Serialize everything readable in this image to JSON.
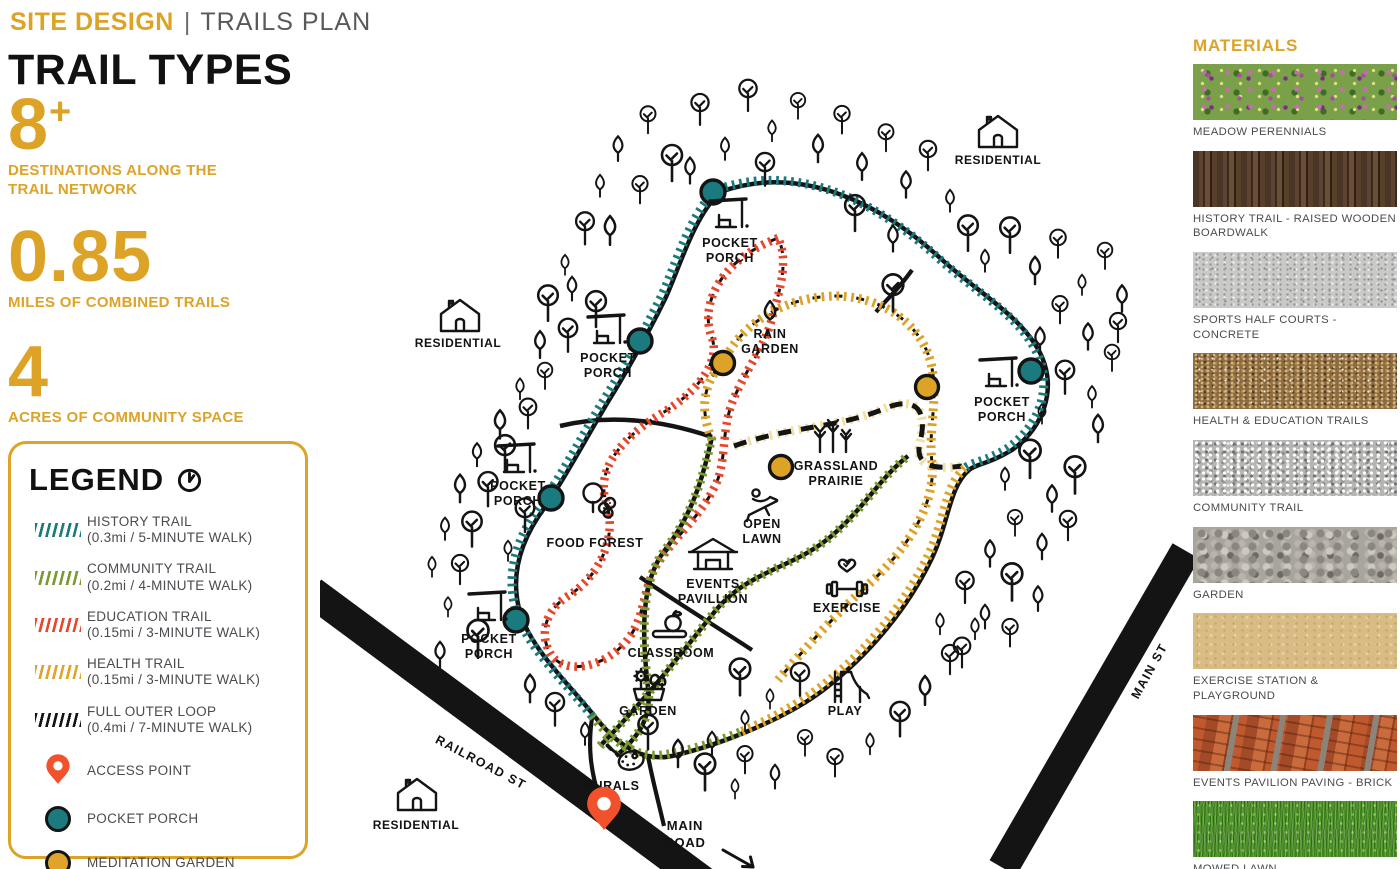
{
  "header": {
    "title": "SITE DESIGN",
    "separator": "|",
    "subtitle": "TRAILS PLAN"
  },
  "page_title": "TRAIL TYPES",
  "stats": [
    {
      "value": "8",
      "suffix": "+",
      "label": "DESTINATIONS ALONG THE TRAIL NETWORK"
    },
    {
      "value": "0.85",
      "suffix": "",
      "label": "MILES OF COMBINED TRAILS"
    },
    {
      "value": "4",
      "suffix": "",
      "label": "ACRES OF COMMUNITY SPACE"
    }
  ],
  "legend": {
    "title": "LEGEND",
    "items": [
      {
        "type": "hatch",
        "color": "#1b7a7e",
        "label": "HISTORY TRAIL",
        "detail": "(0.3mi / 5-MINUTE WALK)"
      },
      {
        "type": "hatch",
        "color": "#7c9a31",
        "label": "COMMUNITY TRAIL",
        "detail": "(0.2mi / 4-MINUTE WALK)"
      },
      {
        "type": "hatch",
        "color": "#e8472b",
        "label": "EDUCATION TRAIL",
        "detail": "(0.15mi / 3-MINUTE WALK)"
      },
      {
        "type": "hatch",
        "color": "#e0a32c",
        "label": "HEALTH TRAIL",
        "detail": "(0.15mi / 3-MINUTE WALK)"
      },
      {
        "type": "hatch",
        "color": "#141414",
        "label": "FULL OUTER LOOP",
        "detail": "(0.4mi / 7-MINUTE WALK)"
      },
      {
        "type": "pin",
        "color": "#f1512b",
        "label": "ACCESS POINT",
        "detail": ""
      },
      {
        "type": "dot",
        "color": "#1b7a7e",
        "label": "POCKET  PORCH",
        "detail": ""
      },
      {
        "type": "dot",
        "color": "#e0a32c",
        "label": "MEDITATION GARDEN",
        "detail": ""
      }
    ]
  },
  "materials": {
    "title": "MATERIALS",
    "items": [
      {
        "label": "MEADOW PERENNIALS",
        "texture": "meadow"
      },
      {
        "label": "HISTORY TRAIL - RAISED WOODEN BOARDWALK",
        "texture": "wood"
      },
      {
        "label": "SPORTS HALF COURTS - CONCRETE",
        "texture": "concrete"
      },
      {
        "label": "HEALTH & EDUCATION TRAILS",
        "texture": "dirt"
      },
      {
        "label": "COMMUNITY TRAIL",
        "texture": "gravel-fine"
      },
      {
        "label": "GARDEN",
        "texture": "gravel-coarse"
      },
      {
        "label": "EXERCISE STATION & PLAYGROUND",
        "texture": "sand"
      },
      {
        "label": "EVENTS PAVILION PAVING - BRICK",
        "texture": "brick"
      },
      {
        "label": "MOWED LAWN",
        "texture": "lawn"
      }
    ]
  },
  "map": {
    "roads": [
      {
        "id": "railroad",
        "label": "RAILROAD ST"
      },
      {
        "id": "main-st",
        "label": "MAIN ST"
      },
      {
        "id": "main-road",
        "label": "MAIN ROAD"
      }
    ],
    "places": [
      {
        "id": "pp-top",
        "icon": "porch",
        "lines": [
          "POCKET",
          "PORCH"
        ]
      },
      {
        "id": "pp-left-upper",
        "icon": "porch",
        "lines": [
          "POCKET",
          "PORCH"
        ]
      },
      {
        "id": "pp-left-mid",
        "icon": "porch",
        "lines": [
          "POCKET",
          "PORCH"
        ]
      },
      {
        "id": "pp-left-lower",
        "icon": "porch",
        "lines": [
          "POCKET",
          "PORCH"
        ]
      },
      {
        "id": "pp-right",
        "icon": "porch",
        "lines": [
          "POCKET",
          "PORCH"
        ]
      },
      {
        "id": "rain-garden",
        "icon": "droplet",
        "lines": [
          "RAIN",
          "GARDEN"
        ]
      },
      {
        "id": "grassland-prairie",
        "icon": "wheat",
        "lines": [
          "GRASSLAND",
          "PRAIRIE"
        ]
      },
      {
        "id": "open-lawn",
        "icon": "lounger",
        "lines": [
          "OPEN",
          "LAWN"
        ]
      },
      {
        "id": "events-pavillion",
        "icon": "pavilion",
        "lines": [
          "EVENTS",
          "PAVILLION"
        ]
      },
      {
        "id": "exercise",
        "icon": "dumbbell",
        "lines": [
          "EXERCISE"
        ]
      },
      {
        "id": "classroom",
        "icon": "book-apple",
        "lines": [
          "CLASSROOM"
        ]
      },
      {
        "id": "garden",
        "icon": "flowers",
        "lines": [
          "GARDEN"
        ]
      },
      {
        "id": "food-forest",
        "icon": "berry-tree",
        "lines": [
          "FOOD FOREST"
        ]
      },
      {
        "id": "play",
        "icon": "slide",
        "lines": [
          "PLAY"
        ]
      },
      {
        "id": "murals",
        "icon": "palette",
        "lines": [
          "MURALS"
        ]
      },
      {
        "id": "residential-nw",
        "icon": "house",
        "lines": [
          "RESIDENTIAL"
        ]
      },
      {
        "id": "residential-ne",
        "icon": "house",
        "lines": [
          "RESIDENTIAL"
        ]
      },
      {
        "id": "residential-sw",
        "icon": "house",
        "lines": [
          "RESIDENTIAL"
        ]
      }
    ],
    "markers": {
      "pocket_porch": "POCKET PORCH",
      "meditation_garden": "MEDITATION GARDEN",
      "access_point": "ACCESS POINT"
    }
  },
  "colors": {
    "gold": "#dca327",
    "teal": "#1b7a7e",
    "olive": "#7c9a31",
    "red": "#e8472b",
    "pale_gold": "#f2dfa2",
    "black_trail": "#141414",
    "pin_orange": "#f1512b",
    "text_gray": "#58595b"
  }
}
